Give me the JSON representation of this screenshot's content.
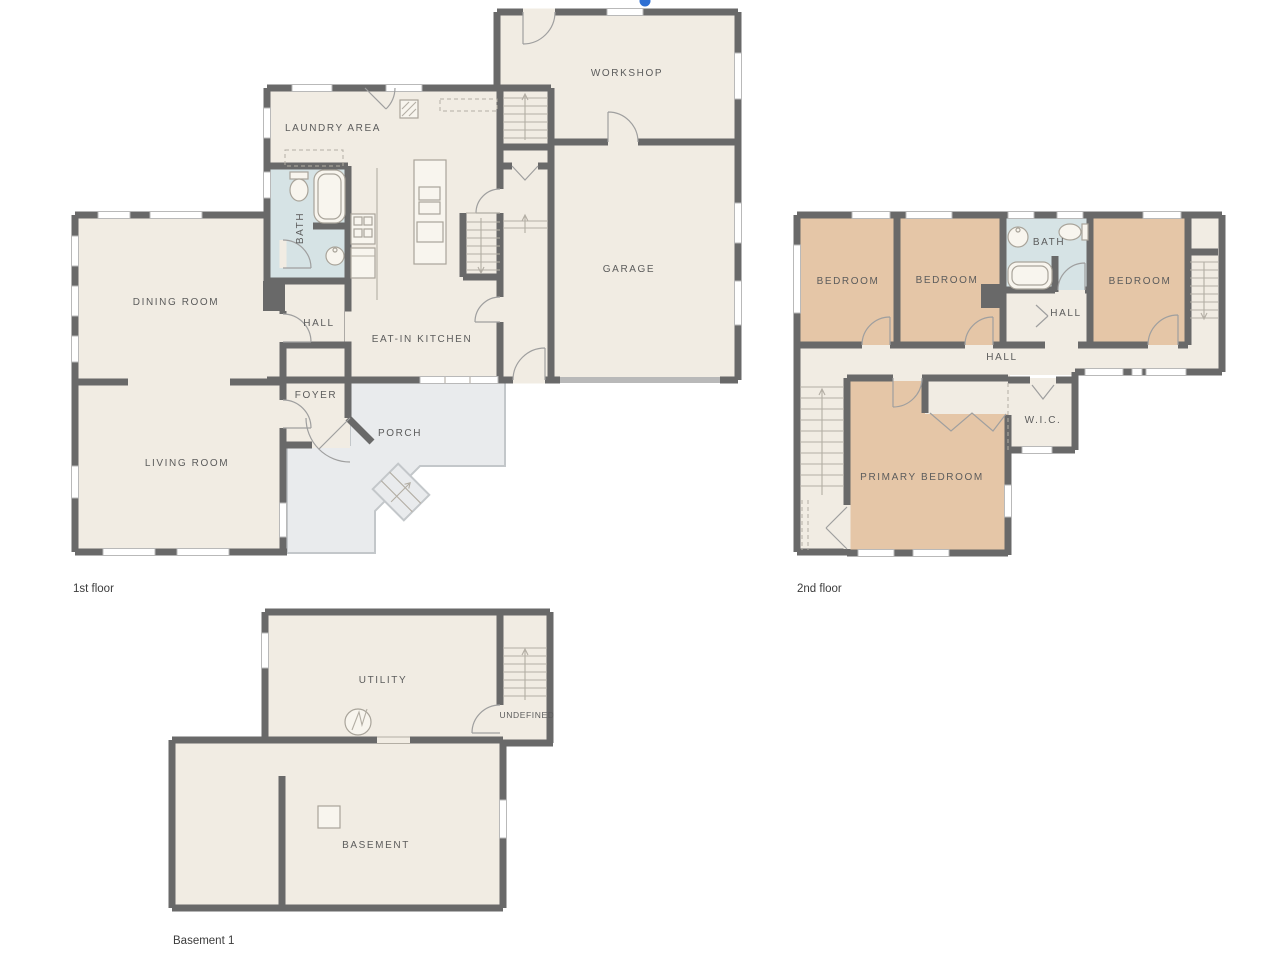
{
  "colors": {
    "wall": "#696969",
    "floor": "#f1ece3",
    "bedroom": "#e5c6a7",
    "bath": "#d6e3e5",
    "porch": "#e9ebed",
    "marker": "#2e6fd3",
    "label": "#5c5c5c",
    "caption": "#3c3c3c"
  },
  "floors": {
    "first": {
      "caption": "1st floor",
      "rooms": {
        "workshop": "WORKSHOP",
        "laundry": "LAUNDRY AREA",
        "bath": "BATH",
        "dining": "DINING ROOM",
        "hall": "HALL",
        "kitchen": "EAT-IN KITCHEN",
        "garage": "GARAGE",
        "foyer": "FOYER",
        "living": "LIVING ROOM",
        "porch": "PORCH"
      }
    },
    "second": {
      "caption": "2nd floor",
      "rooms": {
        "bedroom_left": "BEDROOM",
        "bedroom_middle": "BEDROOM",
        "bath": "BATH",
        "bedroom_right": "BEDROOM",
        "hall_upper": "HALL",
        "hall": "HALL",
        "wic": "W.I.C.",
        "primary": "PRIMARY BEDROOM"
      }
    },
    "basement": {
      "caption": "Basement 1",
      "rooms": {
        "utility": "UTILITY",
        "undefined_room": "UNDEFINED",
        "basement": "BASEMENT"
      }
    }
  }
}
